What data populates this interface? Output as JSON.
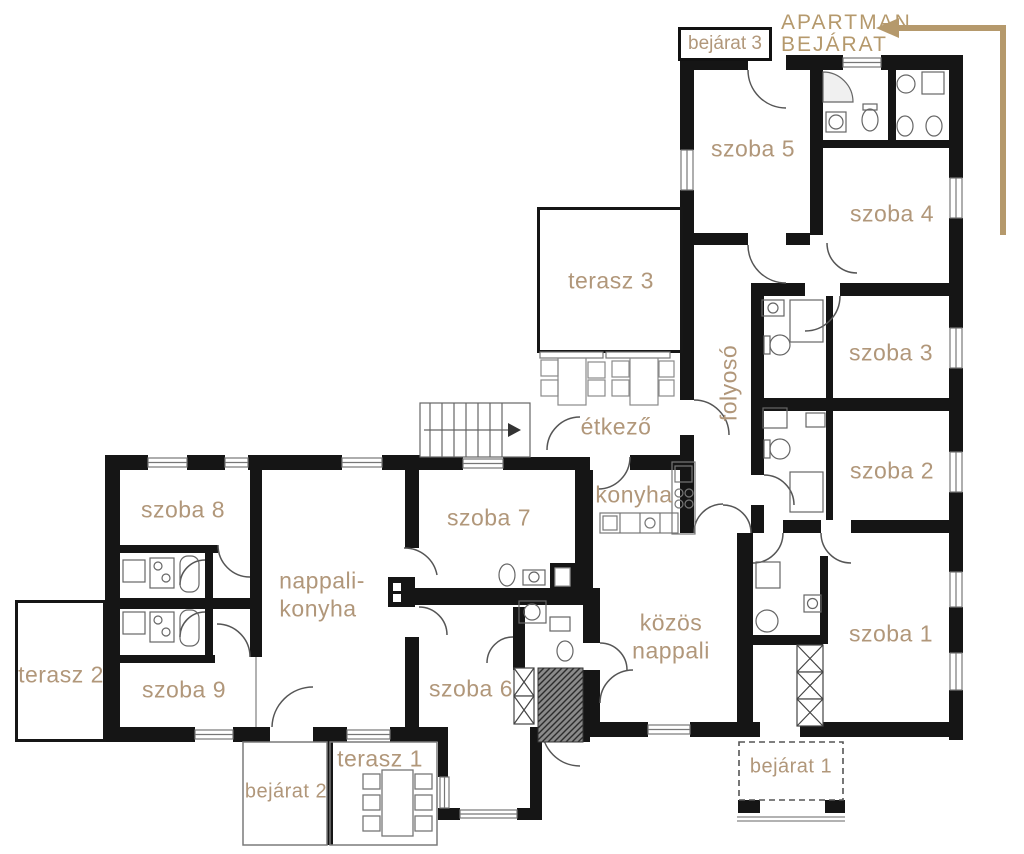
{
  "colors": {
    "label_tan": "#b1977a",
    "annotation_tan": "#b5996c",
    "wall_black": "#151515",
    "fixture_gray": "#666666"
  },
  "annotation": {
    "line1": "APARTMAN",
    "line2": "BEJÁRAT"
  },
  "labels": {
    "szoba1": "szoba 1",
    "szoba2": "szoba 2",
    "szoba3": "szoba 3",
    "szoba4": "szoba 4",
    "szoba5": "szoba 5",
    "szoba6": "szoba 6",
    "szoba7": "szoba 7",
    "szoba8": "szoba 8",
    "szoba9": "szoba 9",
    "folyoso": "folyosó",
    "etkezo": "étkező",
    "konyha": "konyha",
    "nappali_konyha_line1": "nappali-",
    "nappali_konyha_line2": "konyha",
    "kozos_nappali_line1": "közös",
    "kozos_nappali_line2": "nappali",
    "terasz1": "terasz 1",
    "terasz2": "terasz 2",
    "terasz3": "terasz 3",
    "bejarat1": "bejárat 1",
    "bejarat2": "bejárat 2",
    "bejarat3": "bejárat 3"
  }
}
